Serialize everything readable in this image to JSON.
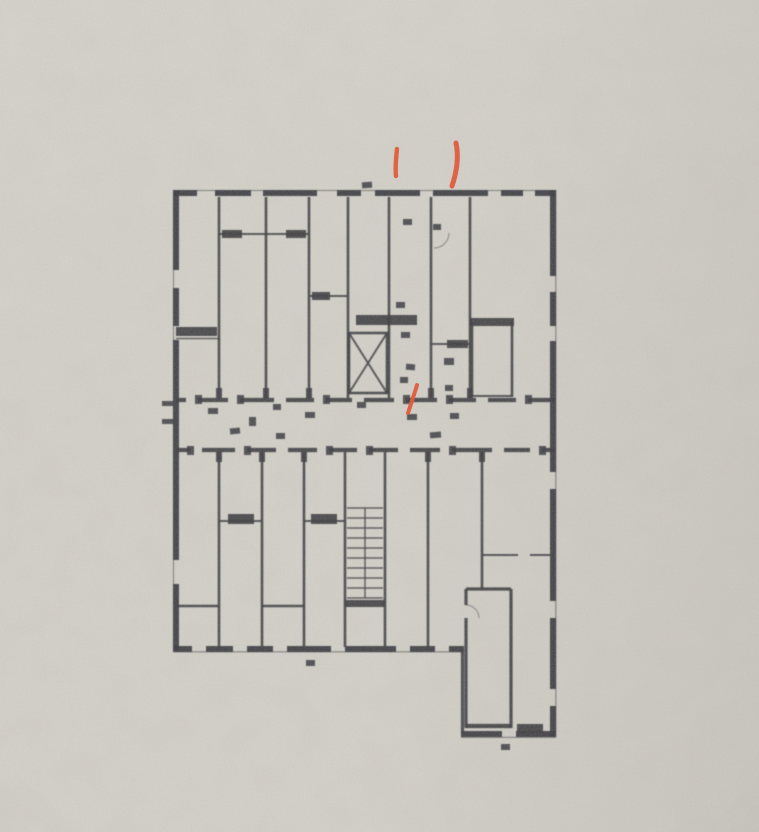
{
  "document": {
    "type": "photograph of a photocopied architectural floor plan on grey paper",
    "visible_text": "no legible text — only tiny blurred room/dimension marks",
    "description": "Blurred photocopied floor plan: two rows of narrow storage rooms separated by a central corridor, a hatched staircase and a crossed elevator shaft in the middle, larger rooms on the right, and a rectangular room in a wing extending at the lower right. Three hand-drawn orange marker ticks annotate the plan."
  },
  "colors": {
    "paper": "#d3d0c8",
    "paper-edge": "#c8c5bd",
    "ink": "#37363b",
    "marker": "#e04e2b"
  },
  "annotations": {
    "marker_strokes": [
      {
        "name": "marker-stroke-top-left",
        "description": "short vertical orange pen stroke above the top wall"
      },
      {
        "name": "marker-stroke-top-right",
        "description": "longer vertical orange pen stroke above the top wall, further right"
      },
      {
        "name": "marker-stroke-corridor",
        "description": "short diagonal orange pen stroke at the central corridor"
      }
    ]
  },
  "floor_plan": {
    "description": "Floor plan of a building level with narrow cellar/storage rooms along a central corridor, stairwell with hatched treads, elevator shaft drawn with an X, window openings in the outer walls, and a lower-right wing room",
    "features": [
      "storage-rooms",
      "central-corridor",
      "staircase",
      "elevator-shaft",
      "windows",
      "door-openings",
      "lower-right-wing"
    ],
    "label_marks": "many small illegible dark marks (room numbers / dimensions)"
  }
}
